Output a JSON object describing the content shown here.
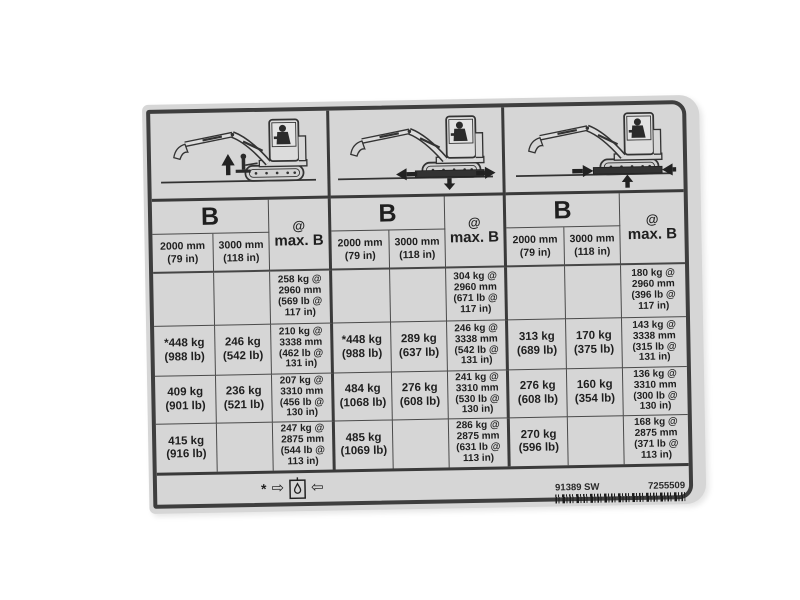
{
  "sticker": {
    "type": "excavator-lift-capacity-label",
    "colors": {
      "label_bg": "#d6d6d6",
      "line": "#3e3e3e",
      "text": "#1f1f1f"
    },
    "groups": [
      {
        "diagram": "excavator-lift-over-front-blade-raised",
        "header": {
          "b": "B",
          "at": "@",
          "max_b": "max. B",
          "col1": "2000 mm\n(79 in)",
          "col2": "3000 mm\n(118 in)"
        },
        "rows": [
          [
            "",
            "",
            "258 kg @\n2960 mm\n(569 lb @\n117 in)"
          ],
          [
            "*448 kg\n(988 lb)",
            "246 kg\n(542 lb)",
            "210 kg @\n3338 mm\n(462 lb @\n131 in)"
          ],
          [
            "409 kg\n(901 lb)",
            "236 kg\n(521 lb)",
            "207 kg @\n3310 mm\n(456 lb @\n130 in)"
          ],
          [
            "415 kg\n(916 lb)",
            "",
            "247 kg @\n2875 mm\n(544 lb @\n113 in)"
          ]
        ]
      },
      {
        "diagram": "excavator-lift-over-side-blade-down",
        "header": {
          "b": "B",
          "at": "@",
          "max_b": "max. B",
          "col1": "2000 mm\n(79 in)",
          "col2": "3000 mm\n(118 in)"
        },
        "rows": [
          [
            "",
            "",
            "304 kg @\n2960 mm\n(671 lb @\n117 in)"
          ],
          [
            "*448 kg\n(988 lb)",
            "289 kg\n(637 lb)",
            "246 kg @\n3338 mm\n(542 lb @\n131 in)"
          ],
          [
            "484 kg\n(1068 lb)",
            "276 kg\n(608 lb)",
            "241 kg @\n3310 mm\n(530 lb @\n130 in)"
          ],
          [
            "485 kg\n(1069 lb)",
            "",
            "286 kg @\n2875 mm\n(631 lb @\n113 in)"
          ]
        ]
      },
      {
        "diagram": "excavator-lift-over-side-blade-up",
        "header": {
          "b": "B",
          "at": "@",
          "max_b": "max. B",
          "col1": "2000 mm\n(79 in)",
          "col2": "3000 mm\n(118 in)"
        },
        "rows": [
          [
            "",
            "",
            "180 kg @\n2960 mm\n(396 lb @\n117 in)"
          ],
          [
            "313 kg\n(689 lb)",
            "170 kg\n(375 lb)",
            "143 kg @\n3338 mm\n(315 lb @\n131 in)"
          ],
          [
            "276 kg\n(608 lb)",
            "160 kg\n(354 lb)",
            "136 kg @\n3310 mm\n(300 lb @\n130 in)"
          ],
          [
            "270 kg\n(596 lb)",
            "",
            "168 kg @\n2875 mm\n(371 lb @\n113 in)"
          ]
        ]
      }
    ],
    "footnote": {
      "asterisk": "*",
      "arrow_right": "⇨",
      "arrow_left": "⇦",
      "symbol": "oil-drop-in-box-icon"
    },
    "part_numbers": {
      "code_left": "91389 SW",
      "code_right": "7255509"
    }
  }
}
